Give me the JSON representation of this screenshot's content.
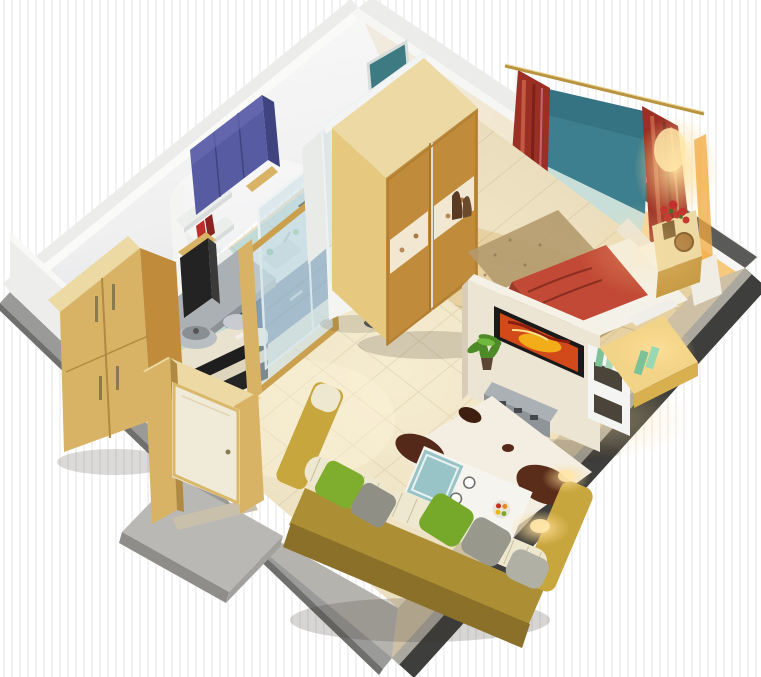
{
  "scene": {
    "kind": "3d-isometric-apartment-cutaway-render",
    "description": "One-room studio apartment 3D floor plan, cutaway axonometric view, no text labels",
    "canvas": {
      "width": 761,
      "height": 677
    }
  },
  "palette": {
    "bg_stripe": "#f2f2f2",
    "outer_light": "#ececea",
    "outer_gray": "#9a9a98",
    "outer_dark": "#3e3e3c",
    "rim_top": "#aba89f",
    "wall_white": "#f1f1ef",
    "wall_shadow": "#dde0e2",
    "floor_tile": "#c3dbd7",
    "floor_wood": "#e7d1a3",
    "wood_light": "#ecd9a4",
    "wood_mid": "#d9b365",
    "wood_dark": "#c08c3c",
    "wood_door": "#cf9a44",
    "cabinet_blue": "#575ba2",
    "cabinet_blue_dark": "#3f4380",
    "kitchen_base": "#32517d",
    "kitchen_base_dark": "#27406a",
    "teal_window": "#3d7f8e",
    "teal_door": "#3d7a82",
    "window_seat": "#c8ded9",
    "curtain_red": "#9c2f24",
    "curtain_light": "#c25a44",
    "bed_red": "#c24936",
    "bed_red_dark": "#9e3a28",
    "bedding_white": "#f4f1e8",
    "sofa_olive": "#ac8f34",
    "sofa_olive_light": "#c7a63e",
    "sofa_olive_dark": "#8a7028",
    "cushion_cream": "#efe8d0",
    "pillow_green": "#7fae2e",
    "pillow_gray": "#98988c",
    "rug_white": "#f3eee1",
    "rug_brown": "#54291a",
    "rug_bed": "#b49a6e",
    "white_paint": "#f4f5f3",
    "partition_cream": "#ece5d4",
    "metal_gray": "#aab0b4",
    "tv_black": "#1a1a1a",
    "art_orange": "#d2491a",
    "art_yellow": "#f5b818",
    "glass_tint": "#c6dce4",
    "plant_green": "#4e8a28",
    "glow_warm": "#ffd98a"
  },
  "rooms": [
    {
      "name": "kitchen",
      "items": [
        "tall-wood-cabinet",
        "open-shelf-books",
        "blue-wall-cabinet",
        "counter-cooktop-sink",
        "blue-base-cabinets",
        "gray-prep-table",
        "wood-trash-bin",
        "pots-and-kettle",
        "sliding-glass-partition",
        "white-fridge-cabinet",
        "dried-plant-vase"
      ]
    },
    {
      "name": "bathroom",
      "items": [
        "frosted-teal-door",
        "washing-machine",
        "glass-enclosure",
        "partition-wall"
      ]
    },
    {
      "name": "bedroom",
      "items": [
        "sliding-door-wardrobe",
        "double-bed-red-blanket",
        "window-bay-teal",
        "window-seat",
        "red-floral-curtains",
        "curtain-rod",
        "nightstand-red-flowers",
        "picture-frame",
        "bed-rug",
        "wall-lamp-glow",
        "floor-vase"
      ]
    },
    {
      "name": "living-room",
      "items": [
        "tv-partition-wall",
        "flat-tv-artwork",
        "av-console-speakers",
        "potted-plant",
        "white-shelf-unit",
        "desk-warm-lamp",
        "straight-olive-sofa",
        "striped-cushions",
        "green-pillows",
        "gray-pillows",
        "white-coffee-table",
        "glass-tray-cups",
        "fruit-bowl",
        "cowhide-rug",
        "floor-lamp-glow"
      ]
    },
    {
      "name": "entry",
      "items": [
        "open-wood-door",
        "door-frame",
        "landing-step",
        "threshold"
      ]
    }
  ]
}
